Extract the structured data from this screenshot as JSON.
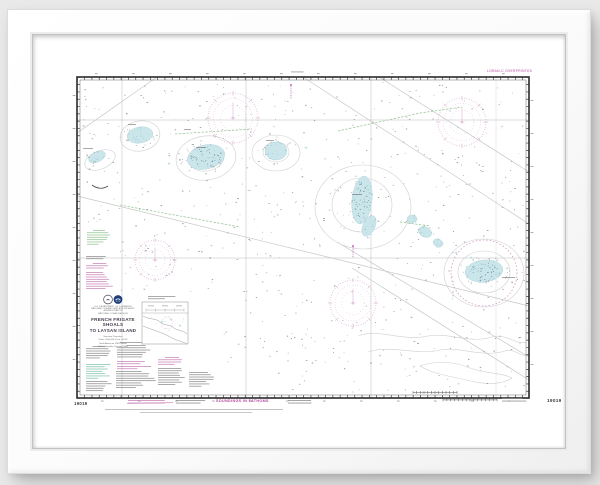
{
  "chart": {
    "number": "19019",
    "title1": "FRENCH FRIGATE SHOALS",
    "title2": "TO LAYSAN ISLAND",
    "agency": [
      "U.S. DEPARTMENT OF COMMERCE",
      "NATIONAL OCEANIC AND ATMOSPHERIC ADMINISTRATION",
      "NATIONAL OCEAN SERVICE"
    ],
    "projection": [
      "Mercator Projection",
      "Scale 1:600,000 at Lat. 24°00'",
      "North American 1983 Datum",
      "(World Geodetic System 1984)"
    ],
    "soundings_note": "SOUNDINGS IN FATHOMS",
    "loran_note": "LORAN-C OVERPRINTED"
  },
  "map_features": {
    "colors": {
      "border": "#2a2a2a",
      "gray": "#c6c6c6",
      "green": "#9cc89a",
      "magenta": "#c77fb5",
      "rose": "#cf98c4",
      "blue_fill": "#c9e5ea",
      "blue_edge": "#a9d2da",
      "blue_dot": "#7db6c2",
      "dense_dot": "#47707c",
      "sounding": "#5f5f5f",
      "note_black": "#8a8a8a",
      "note_green": "#8fc38f",
      "note_teal": "#7fbfae",
      "contour": "#cfcfcf"
    },
    "neatline": {
      "x": 77,
      "y": 77,
      "w": 452,
      "h": 321
    },
    "graticule": {
      "vx": [
        122,
        246,
        371,
        496
      ],
      "hy": [
        120,
        258
      ]
    },
    "diagonals": [
      [
        [
          303,
          77
        ],
        [
          529,
          224
        ]
      ],
      [
        [
          379,
          77
        ],
        [
          529,
          172
        ]
      ],
      [
        [
          77,
          133
        ],
        [
          157,
          77
        ]
      ],
      [
        [
          77,
          196
        ],
        [
          529,
          306
        ]
      ],
      [
        [
          337,
          242
        ],
        [
          529,
          357
        ]
      ],
      [
        [
          352,
          268
        ],
        [
          529,
          380
        ]
      ]
    ],
    "greens": [
      [
        [
          120,
          205
        ],
        [
          240,
          227
        ]
      ],
      [
        [
          175,
          134
        ],
        [
          252,
          129
        ]
      ],
      [
        [
          338,
          131
        ],
        [
          420,
          113
        ],
        [
          462,
          107
        ]
      ],
      [
        [
          400,
          222
        ],
        [
          430,
          226
        ]
      ]
    ],
    "contour_ellipses": [
      {
        "cx": 140,
        "cy": 136,
        "rx": 20,
        "ry": 15,
        "rot": -10
      },
      {
        "cx": 206,
        "cy": 158,
        "rx": 30,
        "ry": 22,
        "rot": -8
      },
      {
        "cx": 206,
        "cy": 158,
        "rx": 18,
        "ry": 13,
        "rot": -8
      },
      {
        "cx": 276,
        "cy": 153,
        "rx": 24,
        "ry": 18,
        "rot": 0
      },
      {
        "cx": 276,
        "cy": 152,
        "rx": 13,
        "ry": 10,
        "rot": 0
      },
      {
        "cx": 363,
        "cy": 207,
        "rx": 48,
        "ry": 42,
        "rot": 0
      },
      {
        "cx": 362,
        "cy": 205,
        "rx": 30,
        "ry": 27,
        "rot": 0
      },
      {
        "cx": 484,
        "cy": 273,
        "rx": 40,
        "ry": 34,
        "rot": 0
      },
      {
        "cx": 484,
        "cy": 272,
        "rx": 26,
        "ry": 21,
        "rot": 0
      },
      {
        "cx": 100,
        "cy": 160,
        "rx": 16,
        "ry": 9,
        "rot": -22
      }
    ],
    "contour_paths": [
      "M 358,336 C 380,328 402,342 428,336 C 448,332 470,344 492,337 C 506,333 518,346 526,342",
      "M 368,352 C 392,344 415,356 440,350 C 458,346 482,358 505,351 C 514,348 523,358 528,355",
      "M 420,366 C 436,360 456,362 470,368 C 486,374 500,372 512,378 C 500,386 482,384 466,380 C 450,376 432,374 420,366 Z"
    ],
    "patches": [
      {
        "cx": 97,
        "cy": 157,
        "rx": 9,
        "ry": 5,
        "rot": -25,
        "dots": 14
      },
      {
        "cx": 140,
        "cy": 135,
        "rx": 13,
        "ry": 8,
        "rot": -10,
        "dots": 26
      },
      {
        "cx": 206,
        "cy": 157,
        "rx": 19,
        "ry": 12,
        "rot": -14,
        "dots": 46
      },
      {
        "cx": 276,
        "cy": 151,
        "rx": 11,
        "ry": 9,
        "rot": 0,
        "dots": 22
      },
      {
        "cx": 362,
        "cy": 200,
        "rx": 10,
        "ry": 24,
        "rot": 6,
        "dots": 40
      },
      {
        "cx": 369,
        "cy": 226,
        "rx": 6,
        "ry": 11,
        "rot": 24,
        "dots": 14
      },
      {
        "cx": 412,
        "cy": 219,
        "rx": 5,
        "ry": 4,
        "rot": 0,
        "dots": 8
      },
      {
        "cx": 425,
        "cy": 232,
        "rx": 7,
        "ry": 5,
        "rot": 28,
        "dots": 10
      },
      {
        "cx": 438,
        "cy": 243,
        "rx": 5,
        "ry": 4,
        "rot": 28,
        "dots": 8
      },
      {
        "cx": 484,
        "cy": 271,
        "rx": 19,
        "ry": 11,
        "rot": -6,
        "dots": 60
      }
    ],
    "mini_patches": [
      [
        168,
        163
      ],
      [
        305,
        147
      ],
      [
        455,
        252
      ],
      [
        470,
        257
      ]
    ],
    "ring": {
      "cx": 484,
      "cy": 273,
      "r": 33
    },
    "roses": [
      {
        "cx": 233,
        "cy": 118,
        "r": 25
      },
      {
        "cx": 462,
        "cy": 122,
        "r": 24
      },
      {
        "cx": 155,
        "cy": 260,
        "r": 20
      },
      {
        "cx": 353,
        "cy": 303,
        "r": 23
      }
    ],
    "beacons": [
      {
        "x": 291,
        "y1": 86,
        "y2": 99
      },
      {
        "x": 353,
        "y1": 247,
        "y2": 258
      }
    ],
    "island_marks": [
      [
        84,
        148,
        9
      ],
      [
        128,
        124,
        8
      ],
      [
        196,
        147,
        10
      ],
      [
        266,
        140,
        8
      ],
      [
        352,
        194,
        10
      ],
      [
        502,
        277,
        13
      ],
      [
        184,
        129,
        7
      ]
    ],
    "arc_mark": "M 92,185 Q 100,191 108,186",
    "soundings": {
      "seed": 12,
      "count": 640,
      "area": [
        82,
        82,
        442,
        311
      ],
      "exclusions": [
        [
          82,
          292,
          136,
          102
        ],
        [
          82,
          224,
          36,
          68
        ]
      ],
      "magenta_specks": 26
    },
    "greek_blocks": [
      {
        "x": 87,
        "y": 230,
        "w": 24,
        "lines": 7,
        "color": "green",
        "heading": true
      },
      {
        "x": 86,
        "y": 256,
        "w": 26,
        "lines": 2,
        "color": "black"
      },
      {
        "x": 86,
        "y": 263,
        "w": 27,
        "lines": 3,
        "color": "magenta",
        "heading": true
      },
      {
        "x": 86,
        "y": 272,
        "w": 27,
        "lines": 8,
        "color": "magenta"
      },
      {
        "x": 86,
        "y": 346,
        "w": 26,
        "lines": 6,
        "color": "black",
        "heading": true
      },
      {
        "x": 86,
        "y": 364,
        "w": 26,
        "lines": 7,
        "color": "teal"
      },
      {
        "x": 86,
        "y": 381,
        "w": 26,
        "lines": 5,
        "color": "black"
      },
      {
        "x": 117,
        "y": 345,
        "w": 38,
        "lines": 6,
        "color": "black",
        "heading": true
      },
      {
        "x": 117,
        "y": 361,
        "w": 38,
        "lines": 2,
        "color": "magenta"
      },
      {
        "x": 117,
        "y": 366,
        "w": 38,
        "lines": 2,
        "color": "magenta"
      },
      {
        "x": 116,
        "y": 371,
        "w": 40,
        "lines": 8,
        "color": "black"
      },
      {
        "x": 158,
        "y": 357,
        "w": 28,
        "lines": 4,
        "color": "magenta",
        "heading": true
      },
      {
        "x": 158,
        "y": 368,
        "w": 28,
        "lines": 8,
        "color": "black"
      },
      {
        "x": 189,
        "y": 372,
        "w": 26,
        "lines": 7,
        "color": "black"
      },
      {
        "x": 148,
        "y": 296,
        "w": 33,
        "lines": 2,
        "color": "black"
      },
      {
        "x": 120,
        "y": 342,
        "w": 96,
        "lines": 1,
        "color": "black"
      },
      {
        "x": 291,
        "y": 71.5,
        "w": 20,
        "lines": 1,
        "color": "black"
      }
    ],
    "inset": {
      "x": 142,
      "y": 302,
      "w": 46,
      "h": 42,
      "coast1": "M 143,316 C 150,320 156,318 160,322 C 164,326 170,324 174,328 C 178,331 183,330 187,334",
      "coast2": "M 143,326 C 152,330 162,332 172,338 C 178,341 184,342 187,344",
      "pink_circle": {
        "cx": 167,
        "cy": 323,
        "r": 6
      },
      "blue_specks": [
        [
          161,
          321
        ],
        [
          170,
          319
        ],
        [
          179,
          325
        ]
      ]
    },
    "bottom": {
      "stamp": {
        "x": 128,
        "y": 400,
        "w": 44,
        "lines": 2
      },
      "note1": {
        "x": 176,
        "y": 400,
        "w": 34,
        "lines": 2
      },
      "note2": {
        "x": 288,
        "y": 400,
        "w": 24,
        "lines": 2
      },
      "note3": {
        "x": 502,
        "y": 398,
        "w": 28,
        "lines": 2
      },
      "line1": {
        "x": 105,
        "y": 409,
        "w": 178
      },
      "line2": {
        "x": 140,
        "y": 412,
        "w": 112
      },
      "bar_inside": {
        "x": 413,
        "y": 391,
        "w": 44,
        "ticks": 12
      },
      "bar_below": {
        "x": 443,
        "y": 398.5,
        "w": 54,
        "ticks": 14
      }
    }
  }
}
